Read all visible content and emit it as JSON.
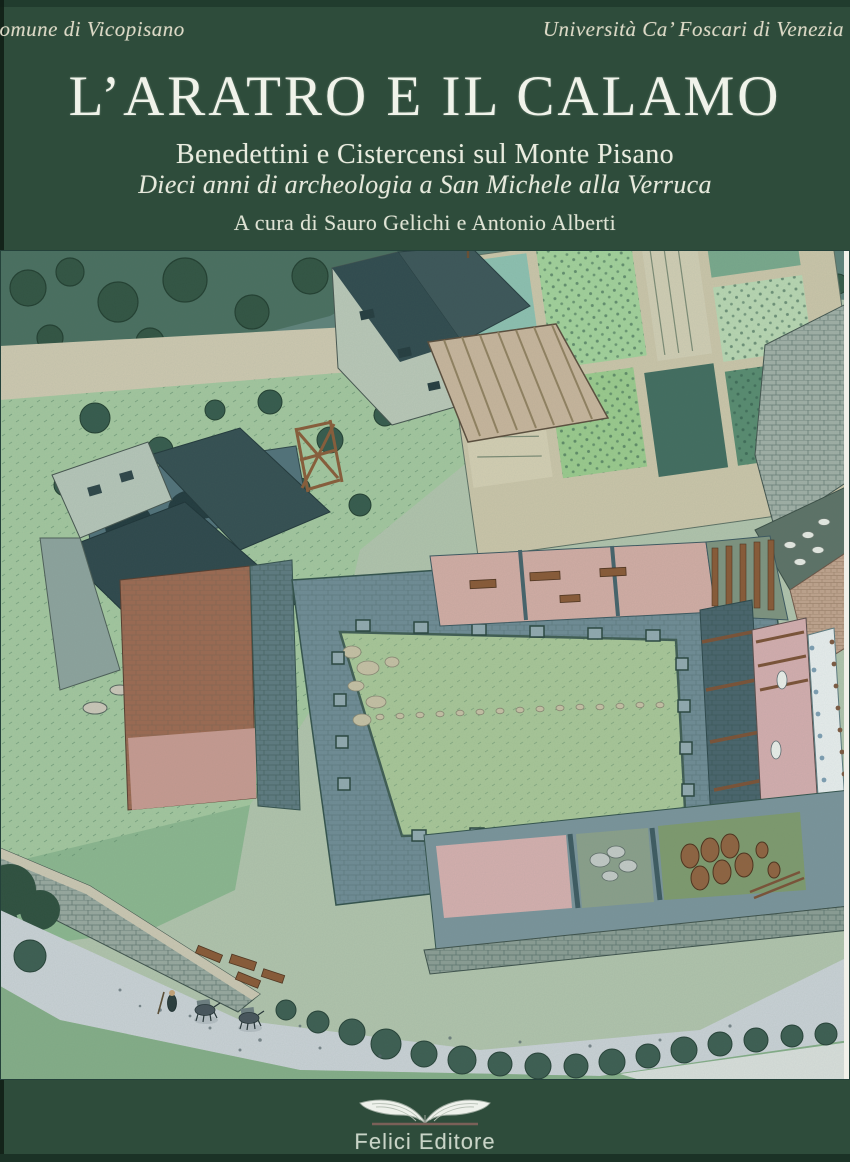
{
  "page": {
    "width": 850,
    "height": 1162
  },
  "header": {
    "left_institution": "Comune di Vicopisano",
    "right_institution": "Università Ca’ Foscari di Venezia"
  },
  "title_block": {
    "title": "L’ARATRO E IL CALAMO",
    "subtitle": "Benedettini e Cistercensi sul Monte Pisano",
    "series_line": "Dieci anni di archeologia a San Michele alla Verruca",
    "editors_line": "A cura di Sauro Gelichi e Antonio Alberti"
  },
  "illustration": {
    "name": "monastery-aerial-illustration"
  },
  "publisher": {
    "logo_icon": "open-book-icon",
    "name": "Felici Editore"
  },
  "colors": {
    "cover_green": "#2e4c3b",
    "text_cream": "#dcd9c6",
    "title_white": "#f0f3ea",
    "logo_text": "#c9d4c7"
  }
}
